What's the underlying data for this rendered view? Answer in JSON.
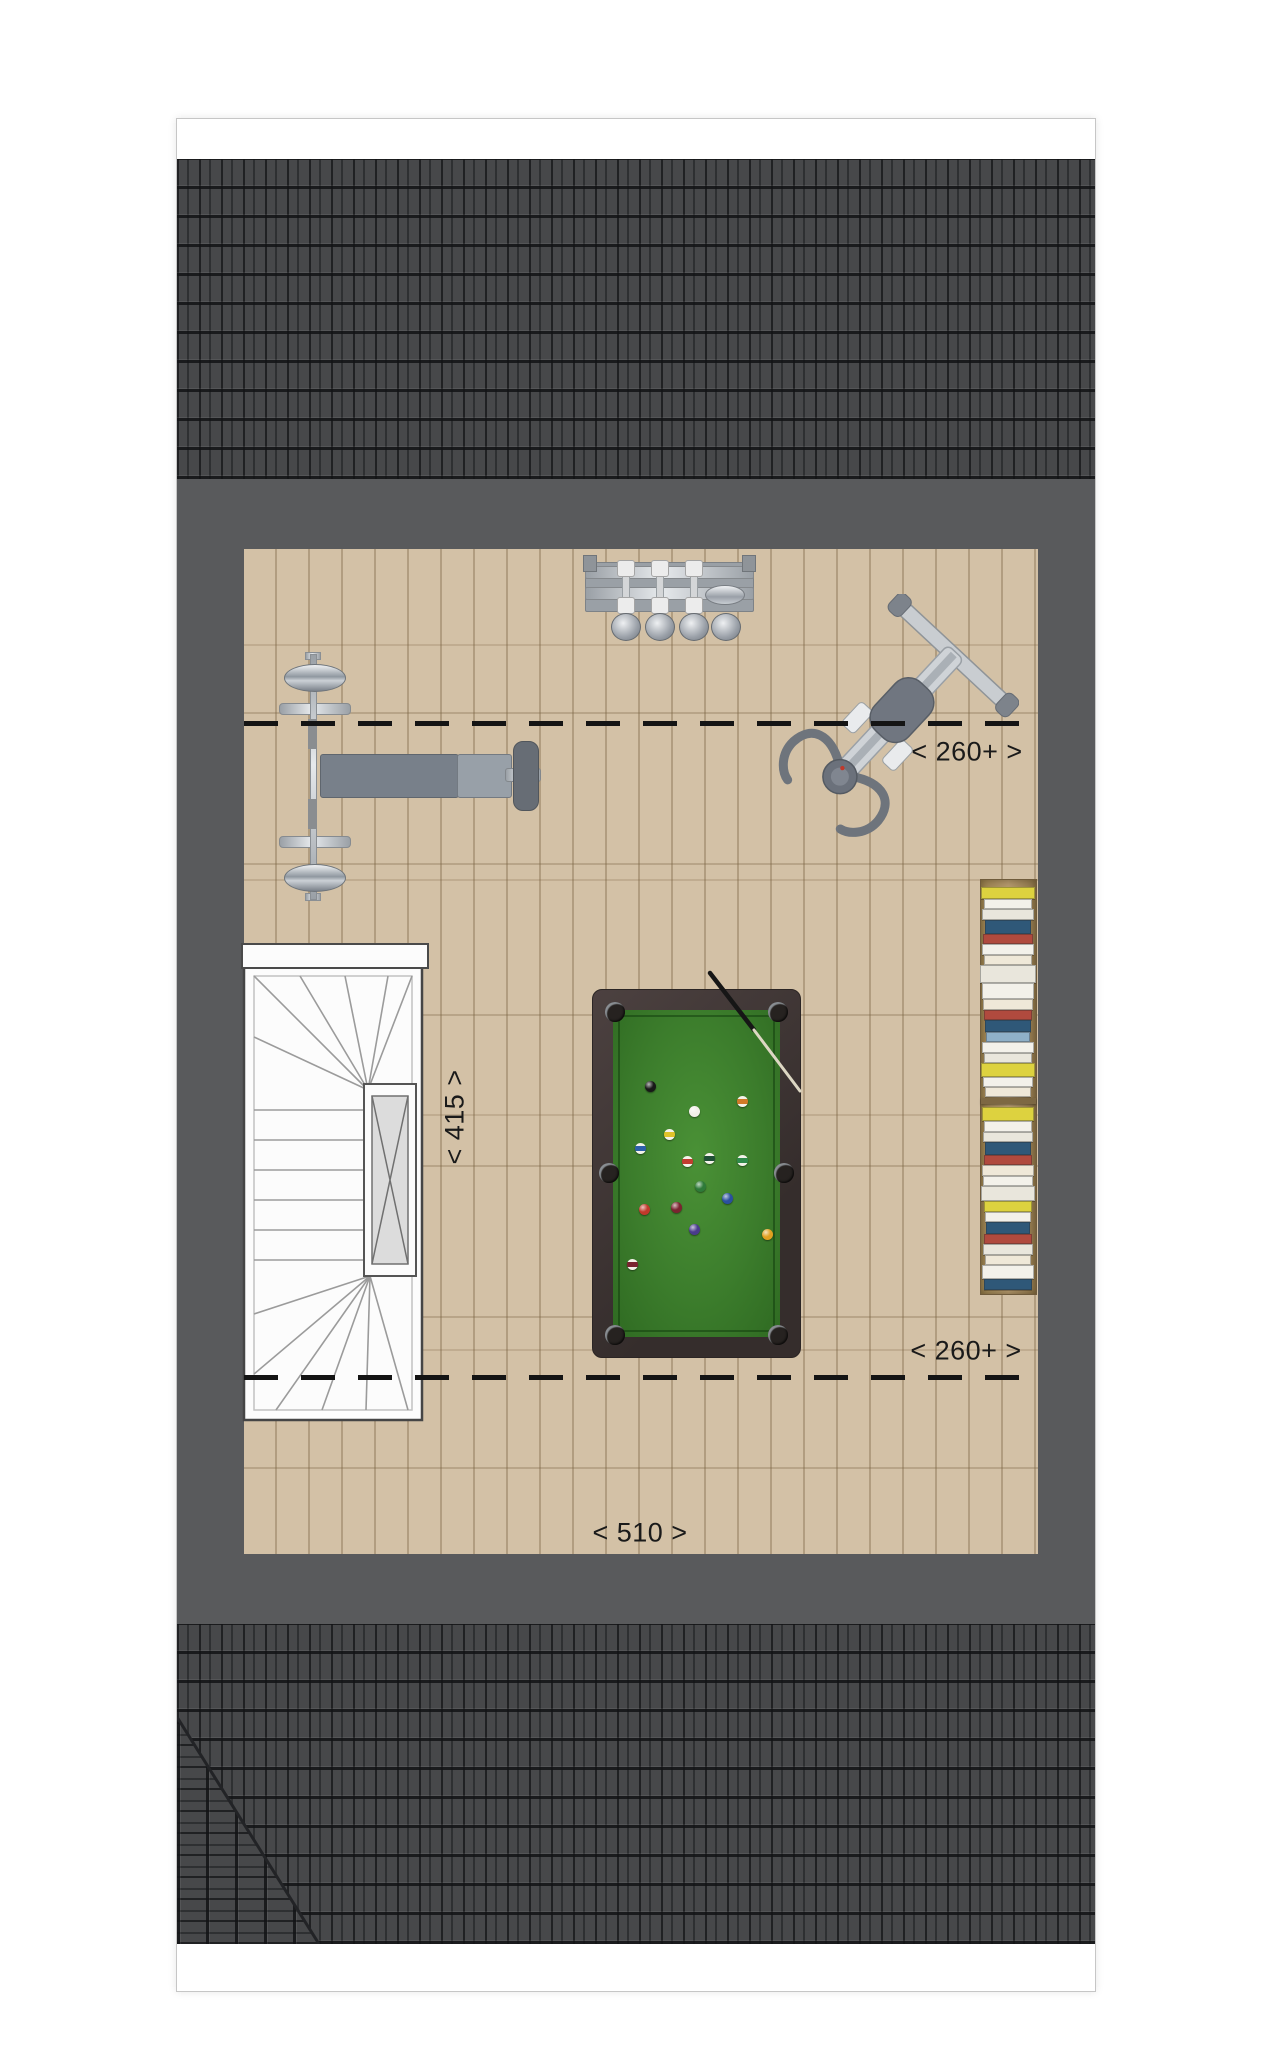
{
  "labels": {
    "headroom_top": "< 260+ >",
    "headroom_bottom": "< 260+ >",
    "width_room": "< 415 >",
    "depth_room": "< 510 >"
  },
  "colors": {
    "page_bg": "#ffffff",
    "page_border": "#c6c6c6",
    "tile": "#47484a",
    "wall": "#595a5c",
    "floor": "#d3c1a6",
    "felt": "#3c7d2c",
    "table_frame": "#3f3534",
    "dash": "#141414",
    "dim": "#1a1a1a"
  },
  "pool_table": {
    "balls": [
      {
        "x": 473,
        "y": 967,
        "c": "#181818",
        "t": "solid"
      },
      {
        "x": 517,
        "y": 992,
        "c": "#f2efe8",
        "t": "cue"
      },
      {
        "x": 565,
        "y": 982,
        "c": "#d07a28",
        "t": "stripe"
      },
      {
        "x": 492,
        "y": 1015,
        "c": "#dfc32a",
        "t": "stripe"
      },
      {
        "x": 463,
        "y": 1029,
        "c": "#2d5fa8",
        "t": "stripe"
      },
      {
        "x": 510,
        "y": 1042,
        "c": "#c23c30",
        "t": "stripe"
      },
      {
        "x": 532,
        "y": 1039,
        "c": "#1f4f35",
        "t": "stripe"
      },
      {
        "x": 565,
        "y": 1041,
        "c": "#2f8a4a",
        "t": "stripe"
      },
      {
        "x": 523,
        "y": 1067,
        "c": "#2e7a39",
        "t": "solid"
      },
      {
        "x": 550,
        "y": 1079,
        "c": "#2a4f9e",
        "t": "solid"
      },
      {
        "x": 467,
        "y": 1090,
        "c": "#c0392b",
        "t": "solid"
      },
      {
        "x": 499,
        "y": 1088,
        "c": "#7a2430",
        "t": "solid"
      },
      {
        "x": 517,
        "y": 1110,
        "c": "#4a3b8c",
        "t": "solid"
      },
      {
        "x": 590,
        "y": 1115,
        "c": "#e0a020",
        "t": "solid"
      },
      {
        "x": 455,
        "y": 1145,
        "c": "#7a2430",
        "t": "stripe"
      }
    ]
  },
  "bookshelf": {
    "top_section_y": 768,
    "bottom_section_y": 988,
    "top_spines": [
      [
        52,
        10,
        "#ddd23f"
      ],
      [
        46,
        8,
        "#f3f1ea"
      ],
      [
        50,
        9,
        "#e9e6dc"
      ],
      [
        44,
        12,
        "#2f5878"
      ],
      [
        48,
        8,
        "#b04a3e"
      ],
      [
        50,
        9,
        "#f3f1ea"
      ],
      [
        46,
        8,
        "#efe8d8"
      ],
      [
        54,
        16,
        "#e9e6dc"
      ],
      [
        50,
        14,
        "#f3f1ea"
      ],
      [
        48,
        9,
        "#efe8d8"
      ],
      [
        46,
        8,
        "#b04a3e"
      ],
      [
        44,
        10,
        "#2f5878"
      ],
      [
        42,
        8,
        "#8fb0c8"
      ],
      [
        50,
        9,
        "#f3f1ea"
      ],
      [
        46,
        8,
        "#e9e6dc"
      ],
      [
        52,
        12,
        "#ddd23f"
      ],
      [
        48,
        8,
        "#f3f1ea"
      ],
      [
        44,
        8,
        "#efe8d8"
      ]
    ],
    "bottom_spines": [
      [
        50,
        12,
        "#ddd23f"
      ],
      [
        46,
        9,
        "#f3f1ea"
      ],
      [
        48,
        8,
        "#e9e6dc"
      ],
      [
        44,
        11,
        "#2f5878"
      ],
      [
        46,
        8,
        "#b04a3e"
      ],
      [
        50,
        9,
        "#efe8d8"
      ],
      [
        48,
        8,
        "#f3f1ea"
      ],
      [
        52,
        13,
        "#e9e6dc"
      ],
      [
        46,
        9,
        "#ddd23f"
      ],
      [
        44,
        8,
        "#f3f1ea"
      ],
      [
        42,
        10,
        "#2f5878"
      ],
      [
        46,
        8,
        "#b04a3e"
      ],
      [
        48,
        9,
        "#e9e6dc"
      ],
      [
        44,
        8,
        "#efe8d8"
      ],
      [
        50,
        12,
        "#f3f1ea"
      ],
      [
        46,
        9,
        "#2f5878"
      ]
    ]
  }
}
